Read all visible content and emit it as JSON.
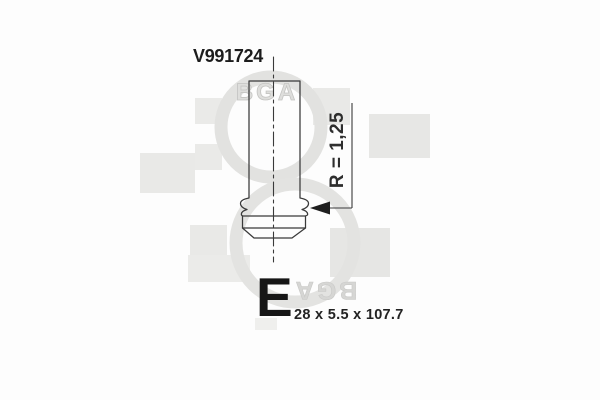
{
  "part": {
    "number": "V991724"
  },
  "drawing": {
    "type": "engine-valve-technical-drawing",
    "dimension_radius_label": "R = 1,25",
    "valve_category_letter": "E",
    "size_label": "28 x 5.5 x 107.7"
  },
  "watermark": {
    "brand": "BGA"
  },
  "colors": {
    "background": "#fdfdfd",
    "outline": "#3a3a3a",
    "text": "#1c1c1c",
    "watermark_square": "#e9e9e7",
    "watermark_ring": "#e2e2e0",
    "watermark_text": "#d6d6d4"
  }
}
